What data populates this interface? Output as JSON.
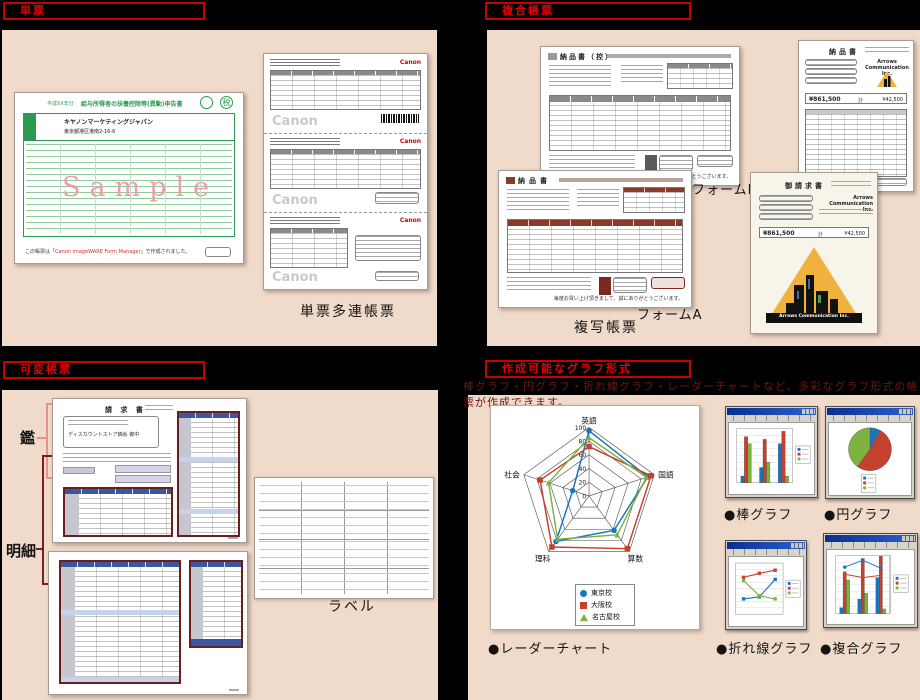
{
  "page": {
    "bg": "#000000",
    "panel_bg": "#F0DACA",
    "header_red": "#E60000",
    "note_red": "#6E1613"
  },
  "tanpyo": {
    "header": "単票",
    "caption": "単票多連帳票",
    "green_form": {
      "era": "平成XX年分",
      "title": "給与所得者の扶養控除等(異動)申告書",
      "stamp": "税",
      "company": "キヤノンマーケティングジャパン",
      "address": "東京都港区港南2-16-6",
      "watermark": "Sample",
      "footer_pre": "この帳票は「",
      "footer_link": "Canon imageWARE Form Manager",
      "footer_post": "」で作成されました。"
    },
    "canon_sheet": {
      "logo": "Canon",
      "watermark": "Canon"
    }
  },
  "fukugo": {
    "header": "複合帳票",
    "caption": "複写帳票",
    "form_a_label": "フォームA",
    "form_b_label": "フォームB",
    "doc_copy_title": "納品書（控）",
    "doc_a_title": "納品書",
    "thanks": "毎度お買い上げ頂きまして、誠にありがとうございます。",
    "delivery": {
      "title": "納品書",
      "company": "Arrows Communication Inc.",
      "amount_main": "¥861,500",
      "unit": "計",
      "amount_tax": "¥42,500"
    },
    "invoice": {
      "title": "御請求書",
      "company": "Arrows Communication Inc.",
      "amount_main": "¥861,500",
      "unit": "計",
      "amount_tax": "¥42,500",
      "logo_banner": "Arrows Communication Inc."
    }
  },
  "kahen": {
    "header": "可変帳票",
    "kagami_label": "鑑",
    "meisai_label": "明細",
    "doc_title": "請 求 書",
    "address_to": "ディスカウントストア錦糸 御中",
    "label_caption": "ラベル"
  },
  "graphs": {
    "header": "作成可能なグラフ形式",
    "note": "棒グラフ・円グラフ・折れ線グラフ・レーダーチャートなど、多彩なグラフ形式の帳票が作成できます。",
    "radar_caption": "●レーダーチャート",
    "bar_caption": "●棒グラフ",
    "pie_caption": "●円グラフ",
    "line_caption": "●折れ線グラフ",
    "combo_caption": "●複合グラフ"
  },
  "chart_data": [
    {
      "id": "radar",
      "type": "radar",
      "axes": [
        "英語",
        "国語",
        "算数",
        "理科",
        "社会"
      ],
      "ticks": [
        0,
        20,
        40,
        60,
        80,
        100
      ],
      "max": 100,
      "legend_position": "bottom",
      "series": [
        {
          "name": "東京校",
          "color": "#1B75BC",
          "marker": "circle",
          "values": [
            95,
            90,
            62,
            82,
            25
          ]
        },
        {
          "name": "大阪校",
          "color": "#C5402E",
          "marker": "square",
          "values": [
            72,
            95,
            95,
            92,
            75
          ]
        },
        {
          "name": "名古屋校",
          "color": "#7CB33E",
          "marker": "triangle",
          "values": [
            85,
            88,
            70,
            78,
            62
          ]
        }
      ]
    },
    {
      "id": "bar",
      "type": "bar",
      "categories": [
        "1",
        "2",
        "3"
      ],
      "ylim": [
        0,
        100
      ],
      "grid": true,
      "legend_position": "right",
      "series": [
        {
          "name": "系列1",
          "color": "#1B75BC",
          "values": [
            12,
            28,
            72
          ]
        },
        {
          "name": "系列2",
          "color": "#C5402E",
          "values": [
            85,
            80,
            95
          ]
        },
        {
          "name": "系列3",
          "color": "#7CB33E",
          "values": [
            72,
            38,
            12
          ]
        }
      ]
    },
    {
      "id": "pie",
      "type": "pie",
      "values": [
        8,
        52,
        40
      ],
      "colors": [
        "#1B75BC",
        "#C5402E",
        "#7CB33E"
      ],
      "legend_position": "bottom"
    },
    {
      "id": "line",
      "type": "line",
      "categories": [
        "1",
        "2",
        "3"
      ],
      "ylim": [
        0,
        100
      ],
      "grid": true,
      "legend_position": "right",
      "series": [
        {
          "name": "系列1",
          "color": "#1B75BC",
          "values": [
            30,
            34,
            68
          ]
        },
        {
          "name": "系列2",
          "color": "#C5402E",
          "values": [
            72,
            80,
            86
          ]
        },
        {
          "name": "系列3",
          "color": "#7CB33E",
          "values": [
            66,
            36,
            30
          ]
        }
      ]
    },
    {
      "id": "combo",
      "type": "combo",
      "categories": [
        "1",
        "2",
        "3"
      ],
      "ylim": [
        0,
        100
      ],
      "grid": true,
      "legend_position": "right",
      "bars": [
        {
          "name": "系列1",
          "color": "#1B75BC",
          "values": [
            10,
            25,
            62
          ]
        },
        {
          "name": "系列2",
          "color": "#C5402E",
          "values": [
            72,
            95,
            99
          ]
        },
        {
          "name": "系列3",
          "color": "#7CB33E",
          "values": [
            58,
            35,
            8
          ]
        }
      ],
      "lines": [
        {
          "name": "系列4",
          "color": "#1B75BC",
          "values": [
            80,
            92,
            78
          ]
        },
        {
          "name": "系列5",
          "color": "#C5402E",
          "values": [
            68,
            62,
            66
          ]
        }
      ]
    }
  ]
}
